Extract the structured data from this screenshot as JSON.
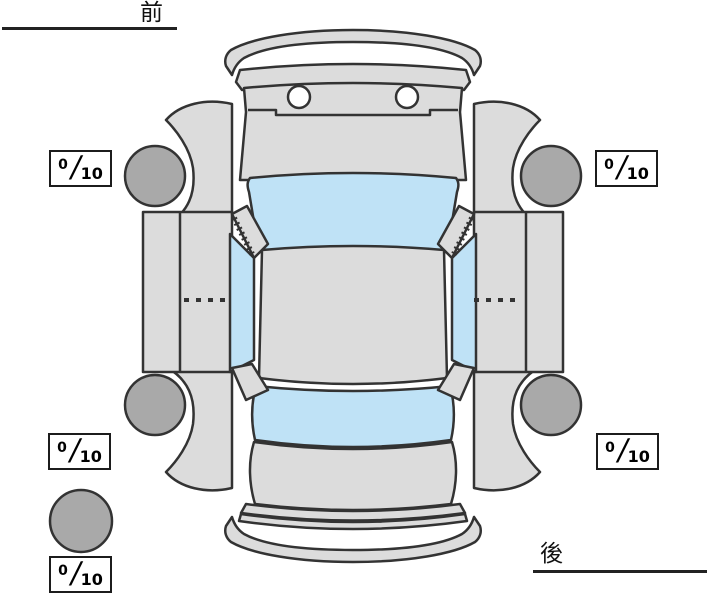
{
  "orientation_labels": {
    "front": "前",
    "rear": "後"
  },
  "tire_scores": {
    "front_left": {
      "value": "0",
      "separator": "/",
      "max": "10"
    },
    "front_right": {
      "value": "0",
      "separator": "/",
      "max": "10"
    },
    "rear_left": {
      "value": "0",
      "separator": "/",
      "max": "10"
    },
    "rear_right": {
      "value": "0",
      "separator": "/",
      "max": "10"
    },
    "spare": {
      "value": "0",
      "separator": "/",
      "max": "10"
    }
  },
  "colors": {
    "bg": "#ffffff",
    "body": "#dcdcdc",
    "glass": "#bfe2f6",
    "tire": "#a9a9a9",
    "outline": "#333333"
  }
}
